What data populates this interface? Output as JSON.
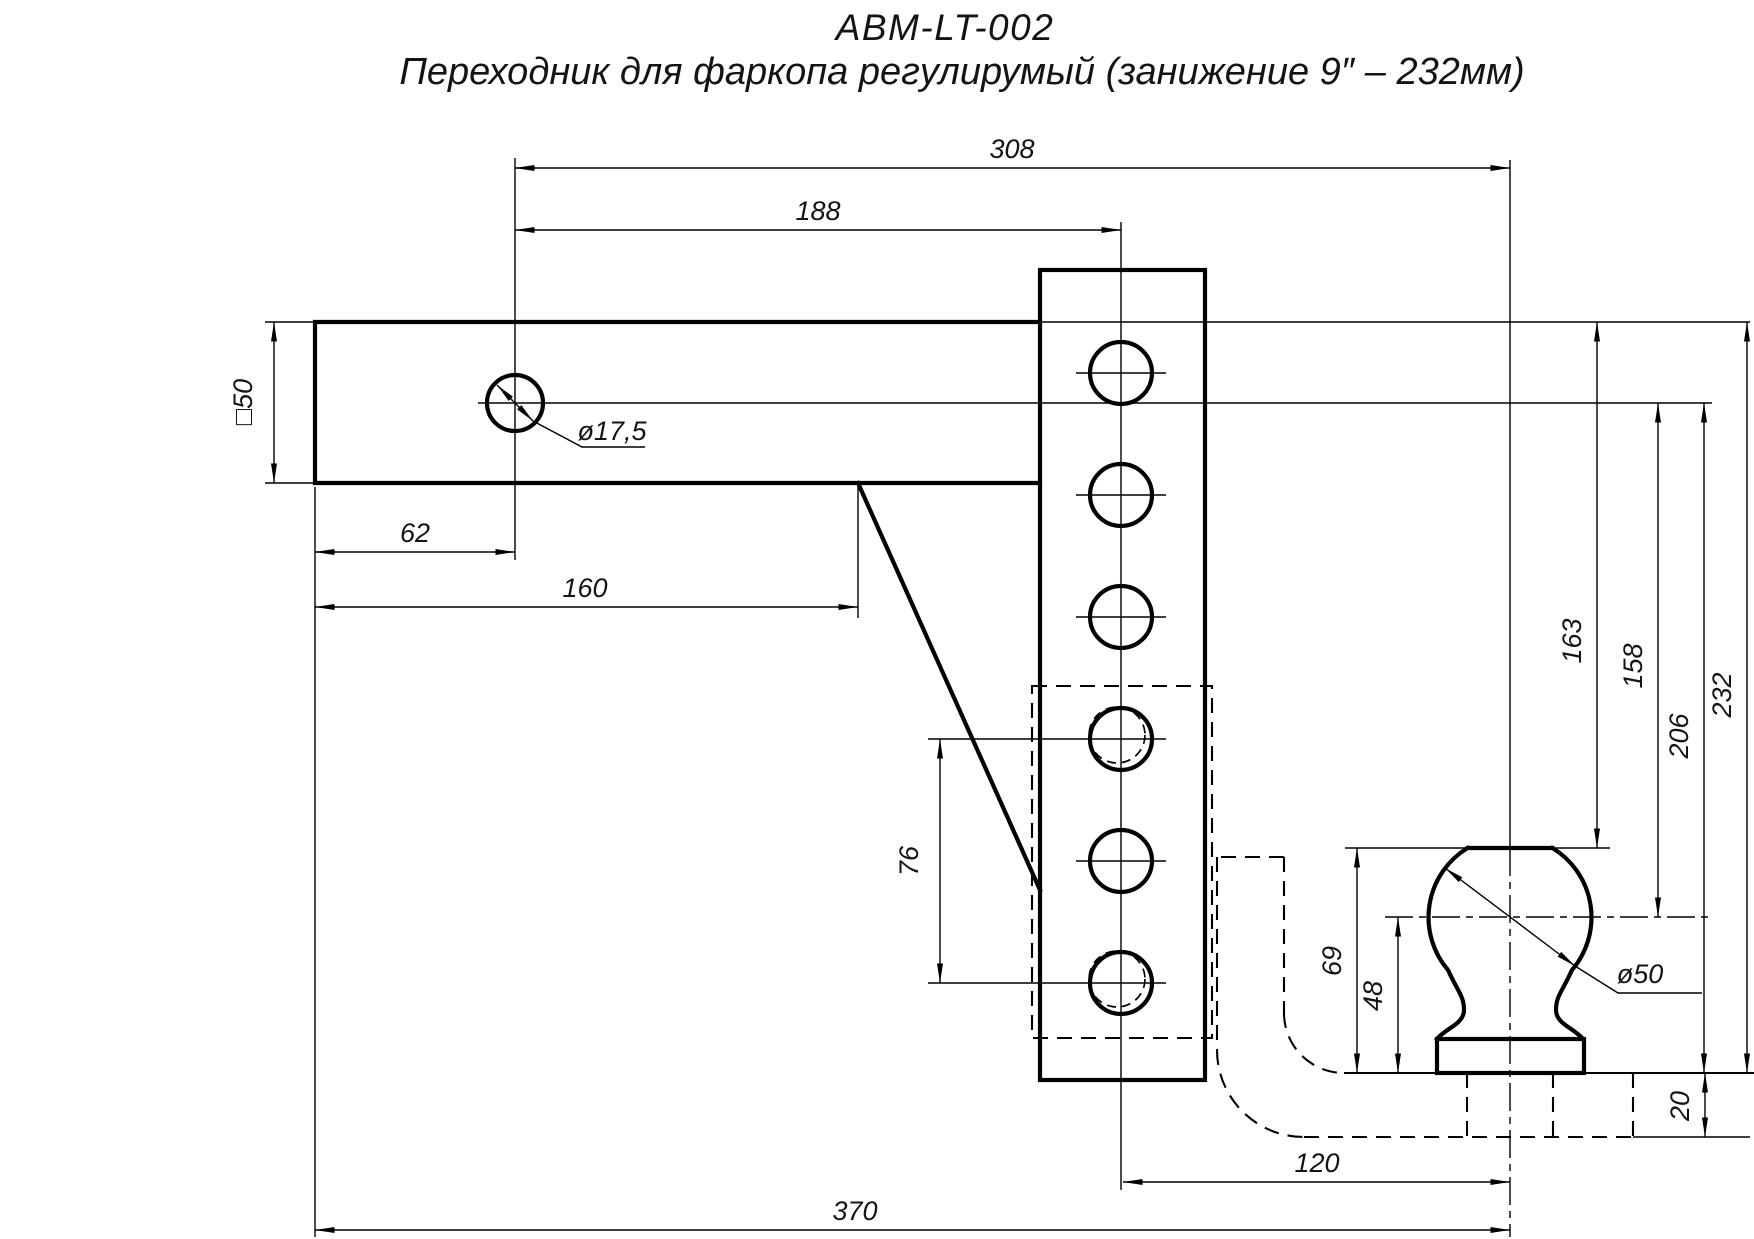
{
  "drawing": {
    "part_number": "ABM-LT-002",
    "title": "Переходник для фаркопа регулирумый (занижение 9″ – 232мм)"
  },
  "dimensions": {
    "length_to_ball": "308",
    "length_to_channel": "188",
    "pin_hole_from_end": "62",
    "shank_usable_length": "160",
    "shank_section": "□50",
    "pin_hole_diameter": "ø17,5",
    "hole_spacing": "76",
    "channel_to_ball": "120",
    "overall_length": "370",
    "drop_to_ball_top": "163",
    "drop_to_ball_center": "158",
    "drop_to_platform": "206",
    "max_drop": "232",
    "ball_total_height": "69",
    "ball_center_height": "48",
    "platform_thickness": "20",
    "ball_diameter": "ø50"
  },
  "colors": {
    "line": "#000000",
    "background": "#ffffff"
  }
}
